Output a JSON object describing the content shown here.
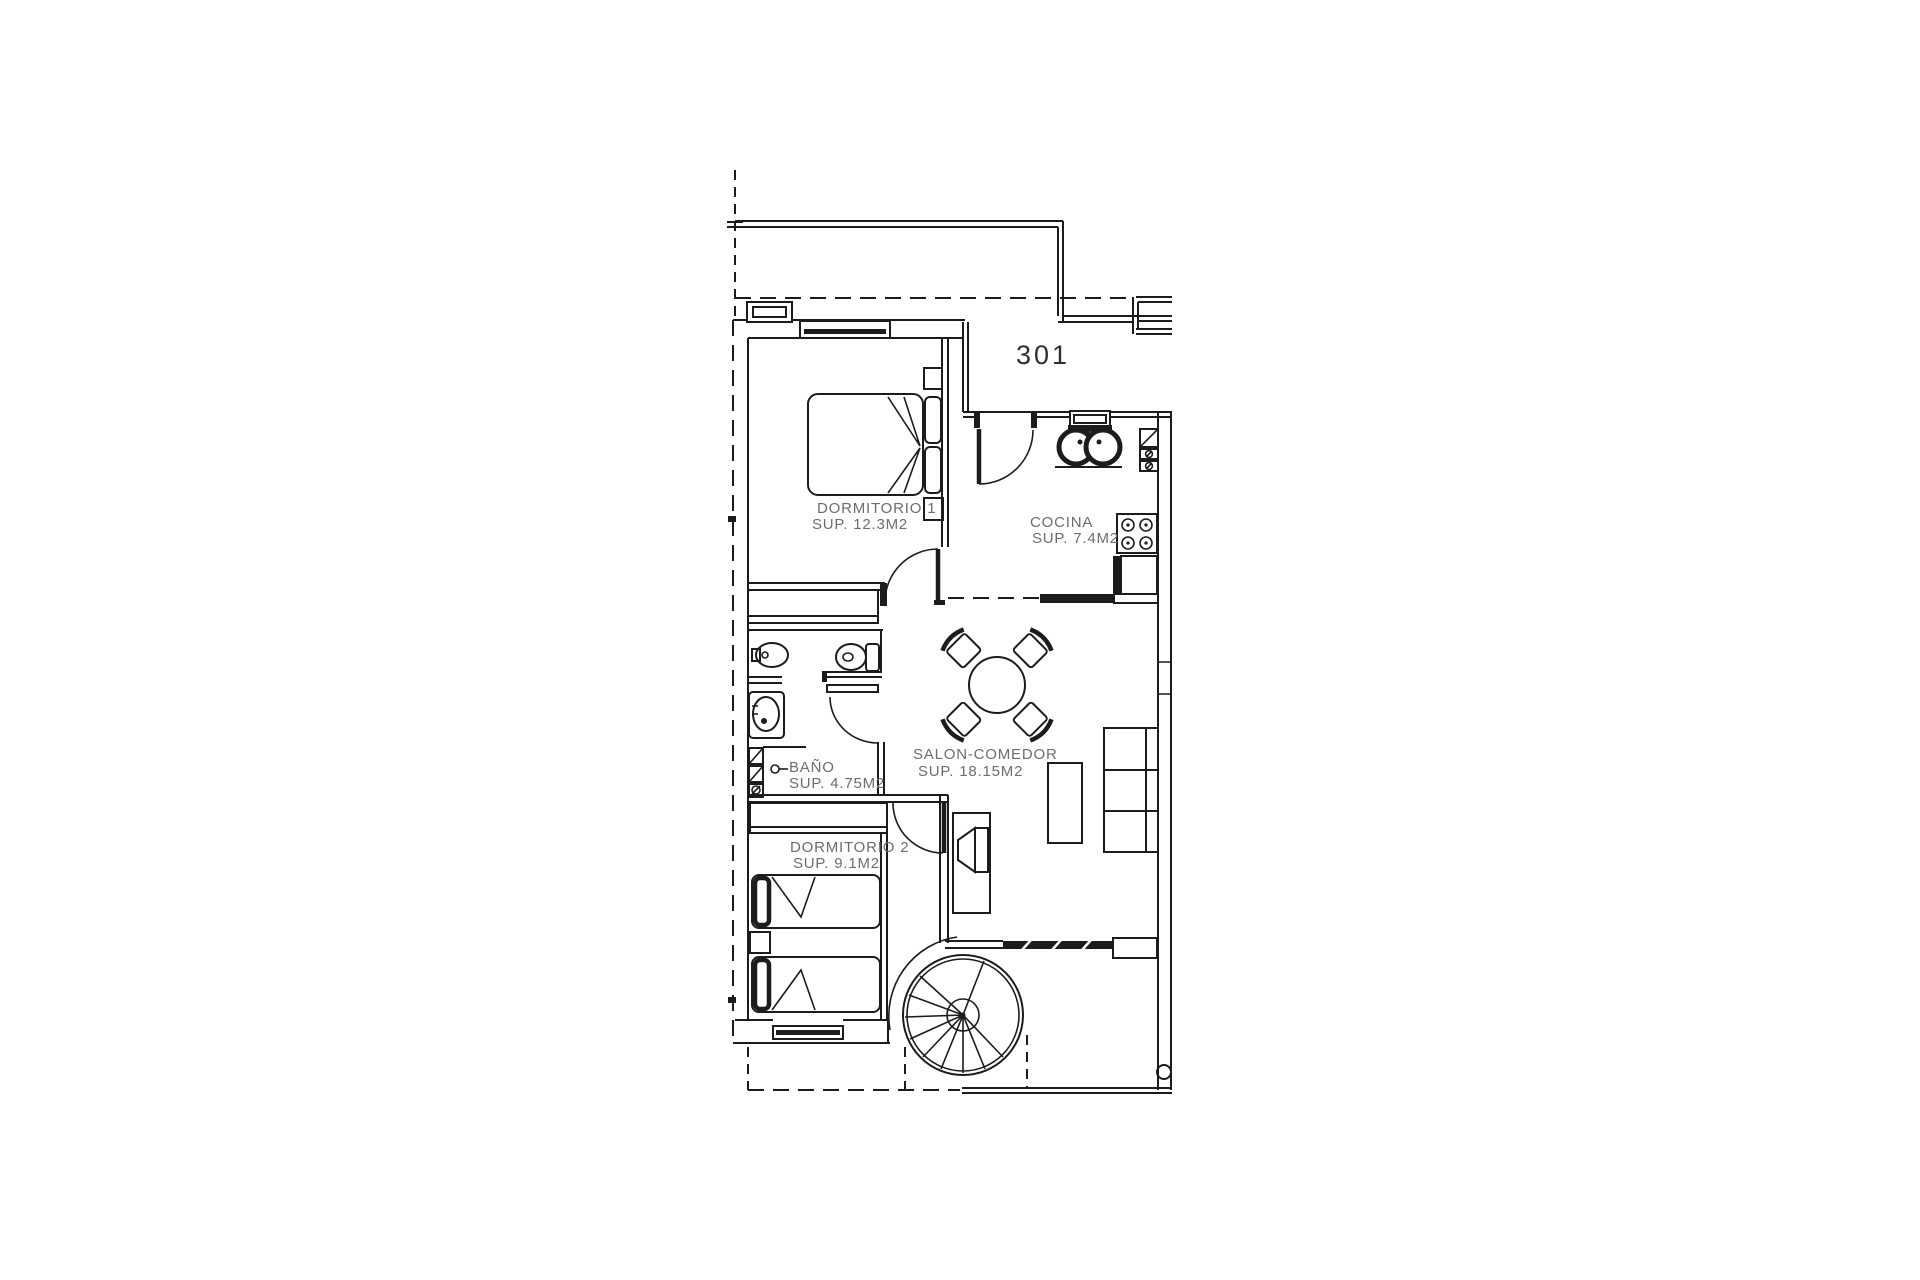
{
  "unit_label": "301",
  "rooms": {
    "dormitorio1": {
      "name": "DORMITORIO 1",
      "area": "SUP. 12.3M2"
    },
    "cocina": {
      "name": "COCINA",
      "area": "SUP. 7.4M2"
    },
    "banio": {
      "name": "BAÑO",
      "area": "SUP. 4.75M2"
    },
    "salon": {
      "name": "SALON-COMEDOR",
      "area": "SUP. 18.15M2"
    },
    "dormitorio2": {
      "name": "DORMITORIO 2",
      "area": "SUP. 9.1M2"
    }
  },
  "colors": {
    "line": "#1c1c1c",
    "text": "#6d6d6d",
    "label_dark": "#2f2f2f",
    "background": "#ffffff"
  }
}
